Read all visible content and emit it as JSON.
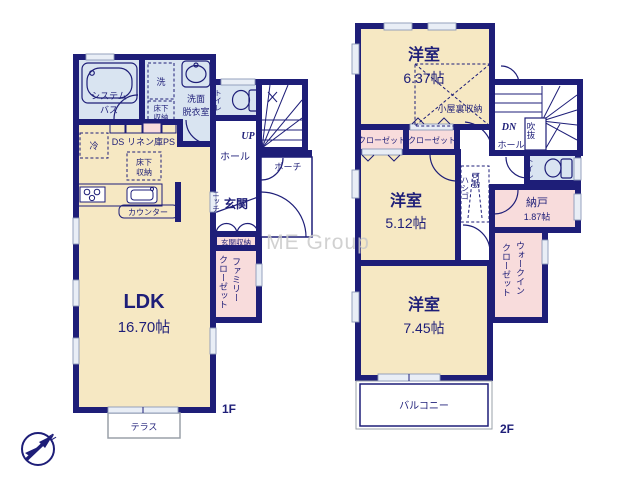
{
  "meta": {
    "watermark": "ME Group",
    "compass_letter": "N"
  },
  "colors": {
    "wall": "#1e1e78",
    "room_cream": "#f6e8c3",
    "wet_blue": "#d9e4f1",
    "closet_pink": "#f8dcdc",
    "text_navy": "#1e1e78",
    "watermark_gray": "#c9c9c9",
    "window": "#e9eef6"
  },
  "f1": {
    "label": "1F",
    "bath_l1": "システム",
    "bath_l2": "バス",
    "washer": "洗",
    "wash_l1": "洗面",
    "wash_l2": "脱衣室",
    "ufs_a_l1": "床下",
    "ufs_a_l2": "収納",
    "toilet": "トイレ",
    "fridge": "冷",
    "ds": "DS",
    "linen": "リネン庫",
    "ps": "PS",
    "ufs_b_l1": "床下",
    "ufs_b_l2": "収納",
    "counter": "カウンター",
    "ldk": "LDK",
    "ldk_size": "16.70帖",
    "niche": "ニッチ",
    "entrance": "玄関",
    "entrance_storage": "玄関収納",
    "hall": "ホール",
    "up": "UP",
    "porch": "ポーチ",
    "famclo_l1": "ファミリー",
    "famclo_l2": "クローゼット",
    "terrace": "テラス"
  },
  "f2": {
    "label": "2F",
    "bed1": "洋室",
    "bed1_size": "6.37帖",
    "attic": "小屋裏収納",
    "closet1": "クローゼット",
    "closet2": "クローゼット",
    "dn": "DN",
    "hall": "ホール",
    "void": "吹抜",
    "toilet": "トイレ",
    "bed2": "洋室",
    "bed2_size": "5.12帖",
    "ladder_l1": "可動",
    "ladder_l2": "ハシゴ",
    "nando": "納戸",
    "nando_size": "1.87帖",
    "wic_l1": "ウォークイン",
    "wic_l2": "クローゼット",
    "bed3": "洋室",
    "bed3_size": "7.45帖",
    "balcony": "バルコニー"
  }
}
